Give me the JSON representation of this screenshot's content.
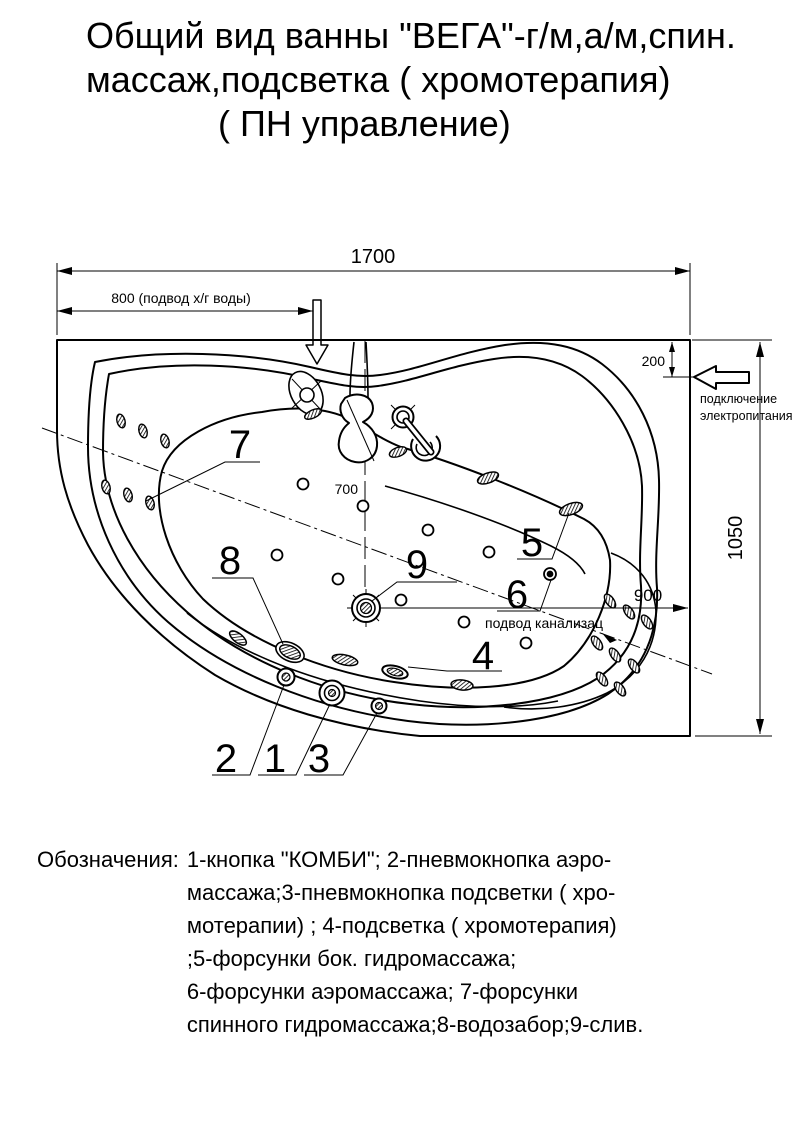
{
  "title": {
    "line1": "Общий вид ванны \"ВЕГА\"-г/м,а/м,спин.",
    "line2": "массаж,подсветка ( хромотерапия)",
    "line3": "( ПН управление)"
  },
  "drawing": {
    "dimensions": {
      "total_length": "1700",
      "water_supply": "800 (подвод х/г воды)",
      "wall_offset": "200",
      "total_width": "1050",
      "drain_offset": "700",
      "sewer_offset": "900"
    },
    "annotations": {
      "power_line1": "подключение",
      "power_line2": "электропитания",
      "sewer": "подвод канализац"
    },
    "callouts": {
      "n1": "1",
      "n2": "2",
      "n3": "3",
      "n4": "4",
      "n5": "5",
      "n6": "6",
      "n7": "7",
      "n8": "8",
      "n9": "9"
    }
  },
  "legend": {
    "label": "Обозначения:",
    "lines": [
      "1-кнопка \"КОМБИ\"; 2-пневмокнопка аэро-",
      "массажа;3-пневмокнопка подсветки ( хро-",
      "мотерапии)  ; 4-подсветка ( хромотерапия)",
      ";5-форсунки бок. гидромассажа;",
      "6-форсунки аэромассажа; 7-форсунки",
      "спинного гидромассажа;8-водозабор;9-слив."
    ]
  }
}
